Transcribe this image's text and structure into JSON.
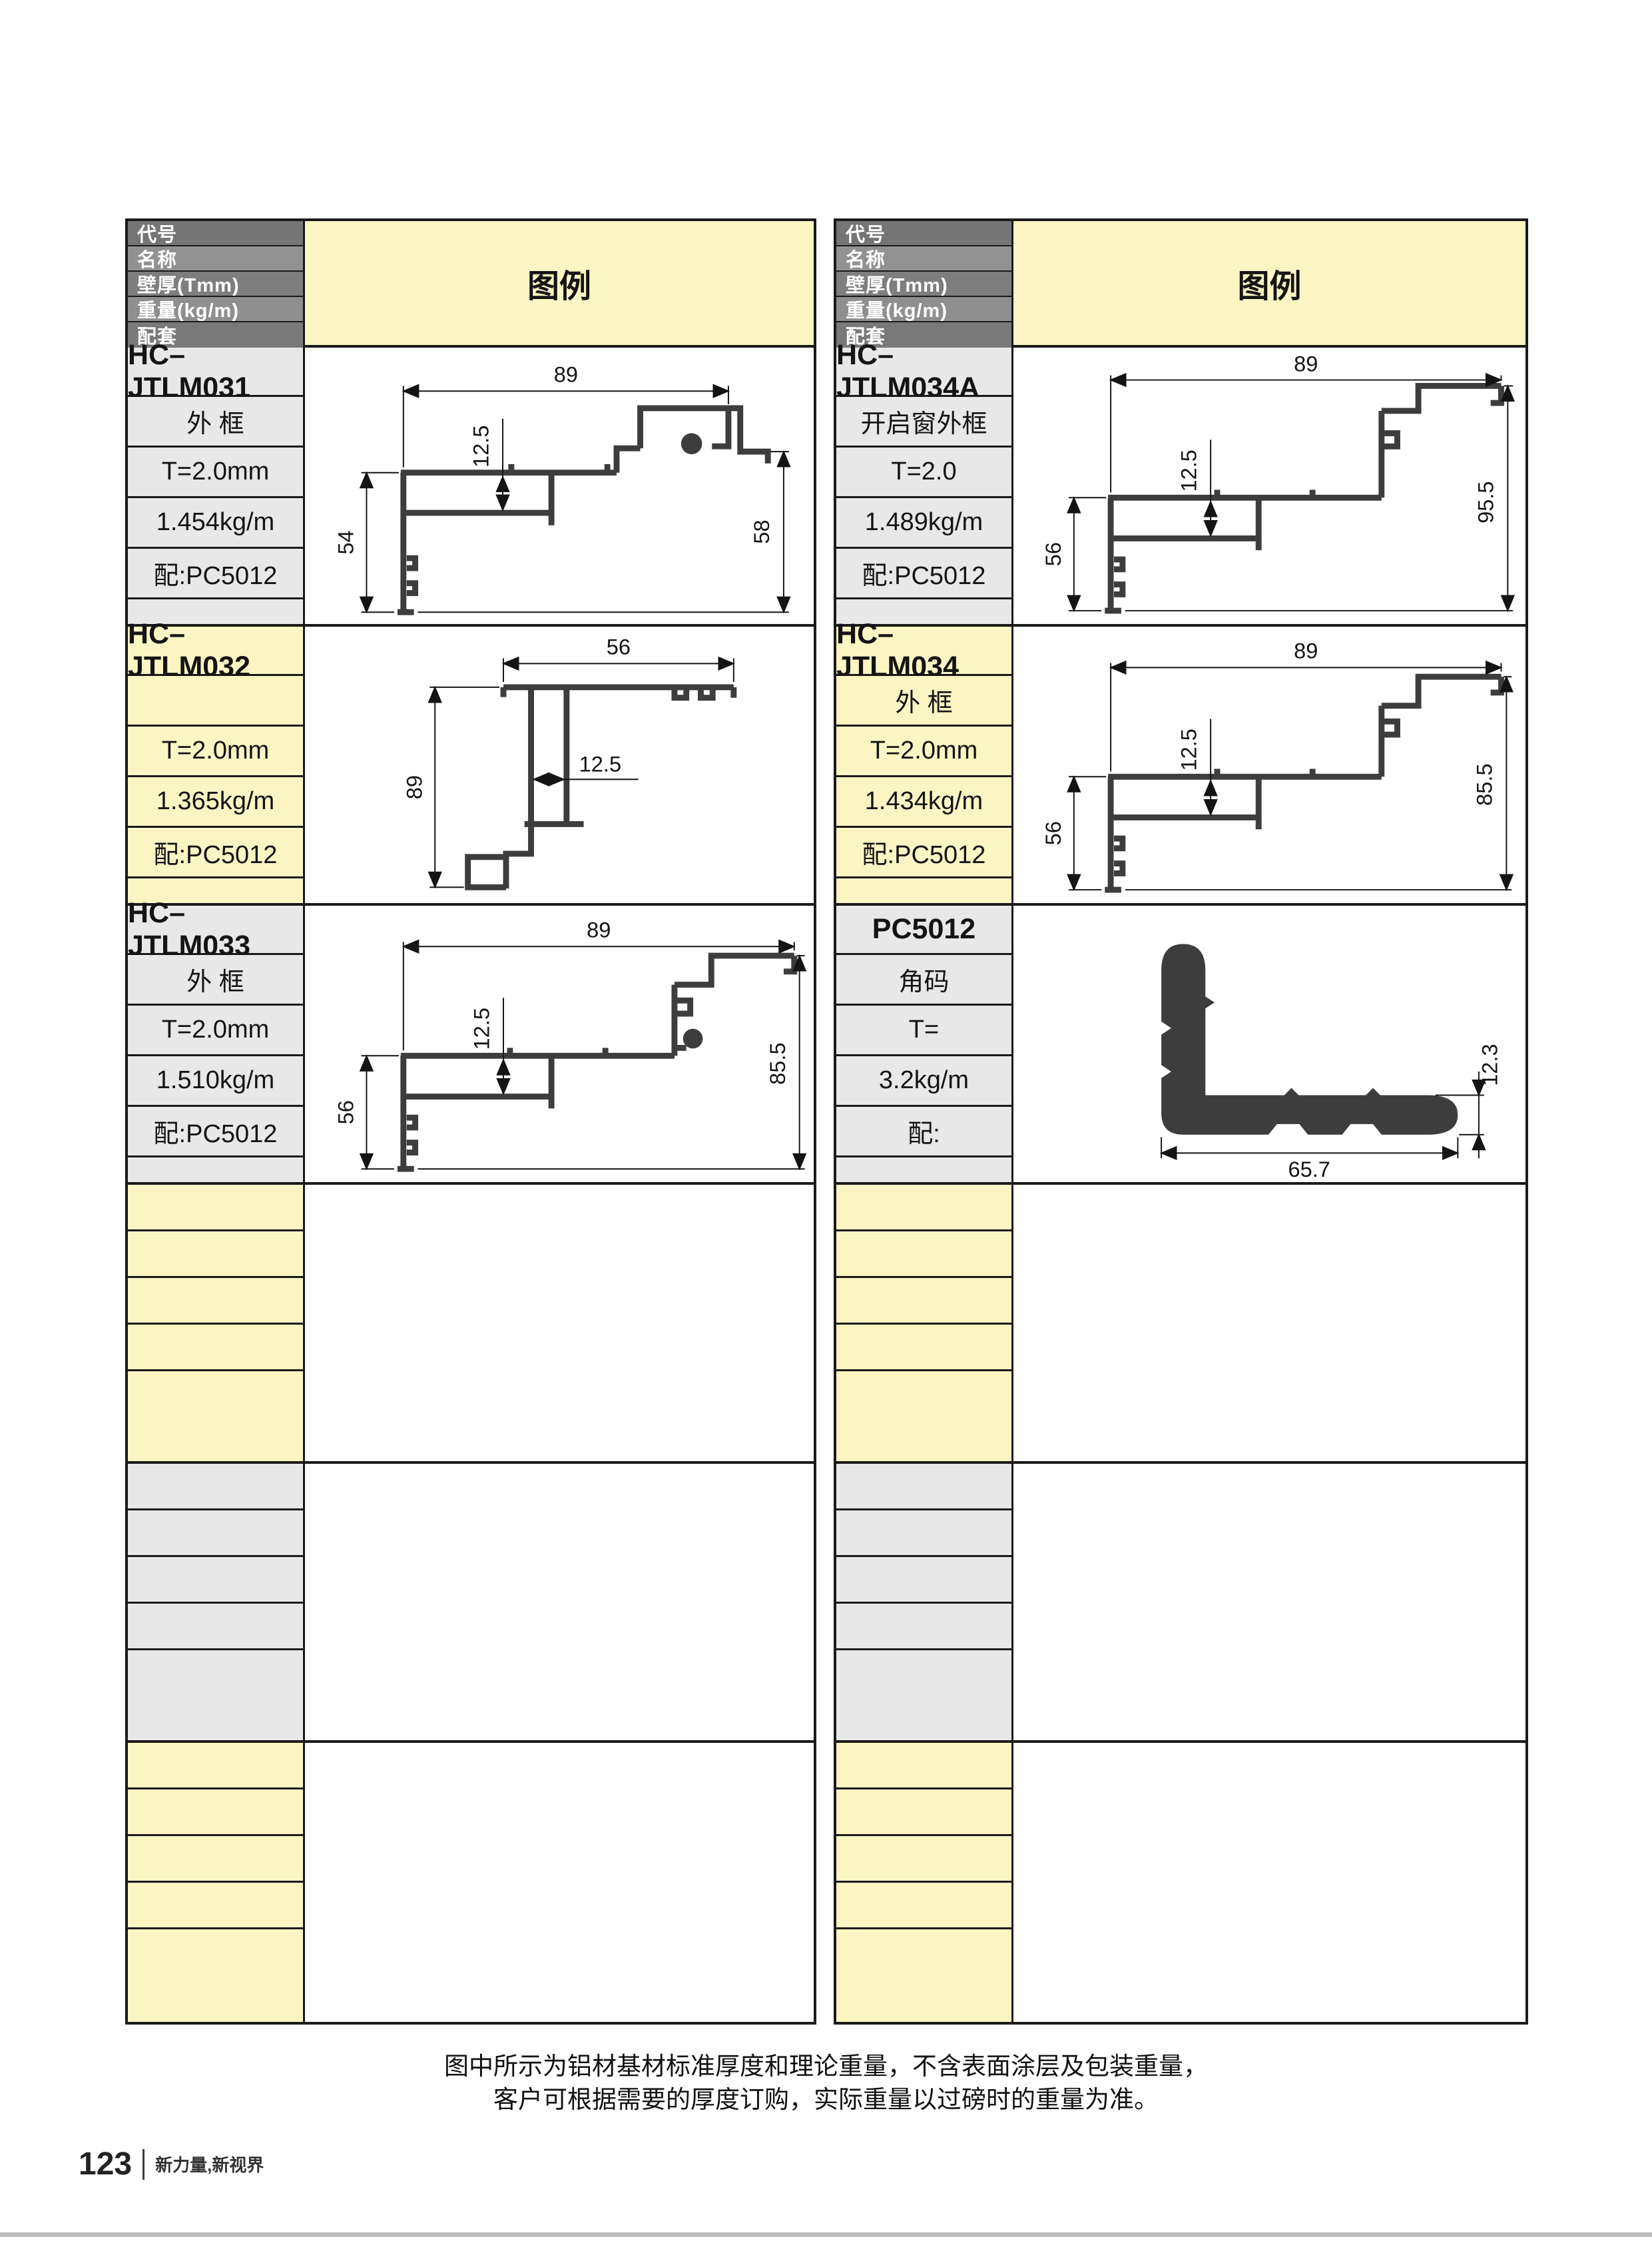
{
  "header": {
    "code": "代号",
    "name": "名称",
    "thickness": "壁厚(Tmm)",
    "weight": "重量(kg/m)",
    "accessory": "配套",
    "legend": "图例"
  },
  "tables": [
    {
      "blocks": [
        {
          "code": "HC–JTLM031",
          "name": "外 框",
          "thickness": "T=2.0mm",
          "weight": "1.454kg/m",
          "accessory": "配:PC5012",
          "dims": {
            "top": "89",
            "inner": "12.5",
            "left": "54",
            "right": "58"
          }
        },
        {
          "code": "HC–JTLM032",
          "name": "",
          "thickness": "T=2.0mm",
          "weight": "1.365kg/m",
          "accessory": "配:PC5012",
          "dims": {
            "top": "56",
            "inner": "12.5",
            "left": "89"
          }
        },
        {
          "code": "HC–JTLM033",
          "name": "外 框",
          "thickness": "T=2.0mm",
          "weight": "1.510kg/m",
          "accessory": "配:PC5012",
          "dims": {
            "top": "89",
            "inner": "12.5",
            "left": "56",
            "right": "85.5"
          }
        }
      ]
    },
    {
      "blocks": [
        {
          "code": "HC–JTLM034A",
          "name": "开启窗外框",
          "thickness": "T=2.0",
          "weight": "1.489kg/m",
          "accessory": "配:PC5012",
          "dims": {
            "top": "89",
            "inner": "12.5",
            "left": "56",
            "right": "95.5"
          }
        },
        {
          "code": "HC–JTLM034",
          "name": "外 框",
          "thickness": "T=2.0mm",
          "weight": "1.434kg/m",
          "accessory": "配:PC5012",
          "dims": {
            "top": "89",
            "inner": "12.5",
            "left": "56",
            "right": "85.5"
          }
        },
        {
          "code": "PC5012",
          "name": "角码",
          "thickness": "T=",
          "weight": "3.2kg/m",
          "accessory": "配:",
          "dims": {
            "bottom": "65.7",
            "right": "12.3"
          }
        }
      ]
    }
  ],
  "footer": {
    "note_line1": "图中所示为铝材基材标准厚度和理论重量，不含表面涂层及包装重量，",
    "note_line2": "客户可根据需要的厚度订购，实际重量以过磅时的重量为准。",
    "page_number": "123",
    "slogan": "新力量,新视界"
  },
  "colors": {
    "legend_yellow": "#faf5c3",
    "cell_gray": "#e8e8e8",
    "header_gray_dark": "#757575",
    "header_gray_light": "#929292",
    "border_black": "#1a1a1a",
    "profile_stroke": "#3d3d3d",
    "bottom_bar_gray": "#bdbdbd"
  }
}
